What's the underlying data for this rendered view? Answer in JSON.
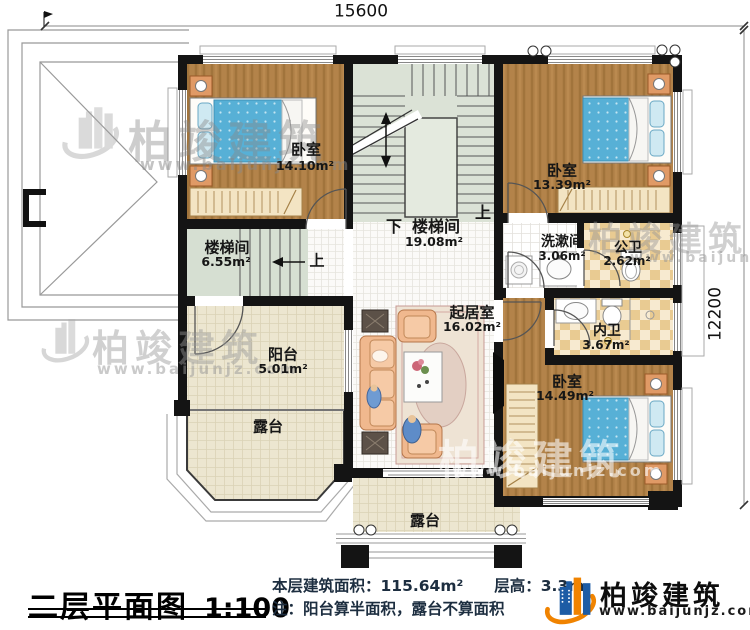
{
  "dimensions": {
    "width_mm": "15600",
    "height_mm": "12200"
  },
  "rooms": {
    "bedroom_top_left": {
      "name": "卧室",
      "area": "14.10m²"
    },
    "bedroom_top_right": {
      "name": "卧室",
      "area": "13.39m²"
    },
    "bedroom_bottom_right": {
      "name": "卧室",
      "area": "14.49m²"
    },
    "stair_hall": {
      "name": "楼梯间",
      "area": "19.08m²",
      "down": "下",
      "up": "上"
    },
    "stair_small": {
      "name": "楼梯间",
      "area": "6.55m²",
      "up": "上"
    },
    "washroom": {
      "name": "洗漱间",
      "area": "3.06m²"
    },
    "public_bathroom": {
      "name": "公卫",
      "area": "2.62m²"
    },
    "private_bathroom": {
      "name": "内卫",
      "area": "3.67m²"
    },
    "living_room": {
      "name": "起居室",
      "area": "16.02m²"
    },
    "balcony": {
      "name": "阳台",
      "area": "5.01m²"
    },
    "terrace_left": {
      "name": "露台"
    },
    "terrace_bottom": {
      "name": "露台"
    }
  },
  "footer": {
    "title": "二层平面图",
    "scale": "1:100",
    "stats_line": "本层建筑面积：115.64m²　　层高：3.3m",
    "note_line": "注：阳台算半面积，露台不算面积"
  },
  "brand": {
    "name": "柏竣建筑",
    "url": "www.baijunjz.com"
  },
  "watermark": {
    "name": "柏竣建筑",
    "url": "www.baijunjz.com"
  },
  "colors": {
    "wall": "#141414",
    "wood": "#b3834a",
    "brand_blue": "#1d5ca5",
    "brand_orange": "#f08300"
  }
}
